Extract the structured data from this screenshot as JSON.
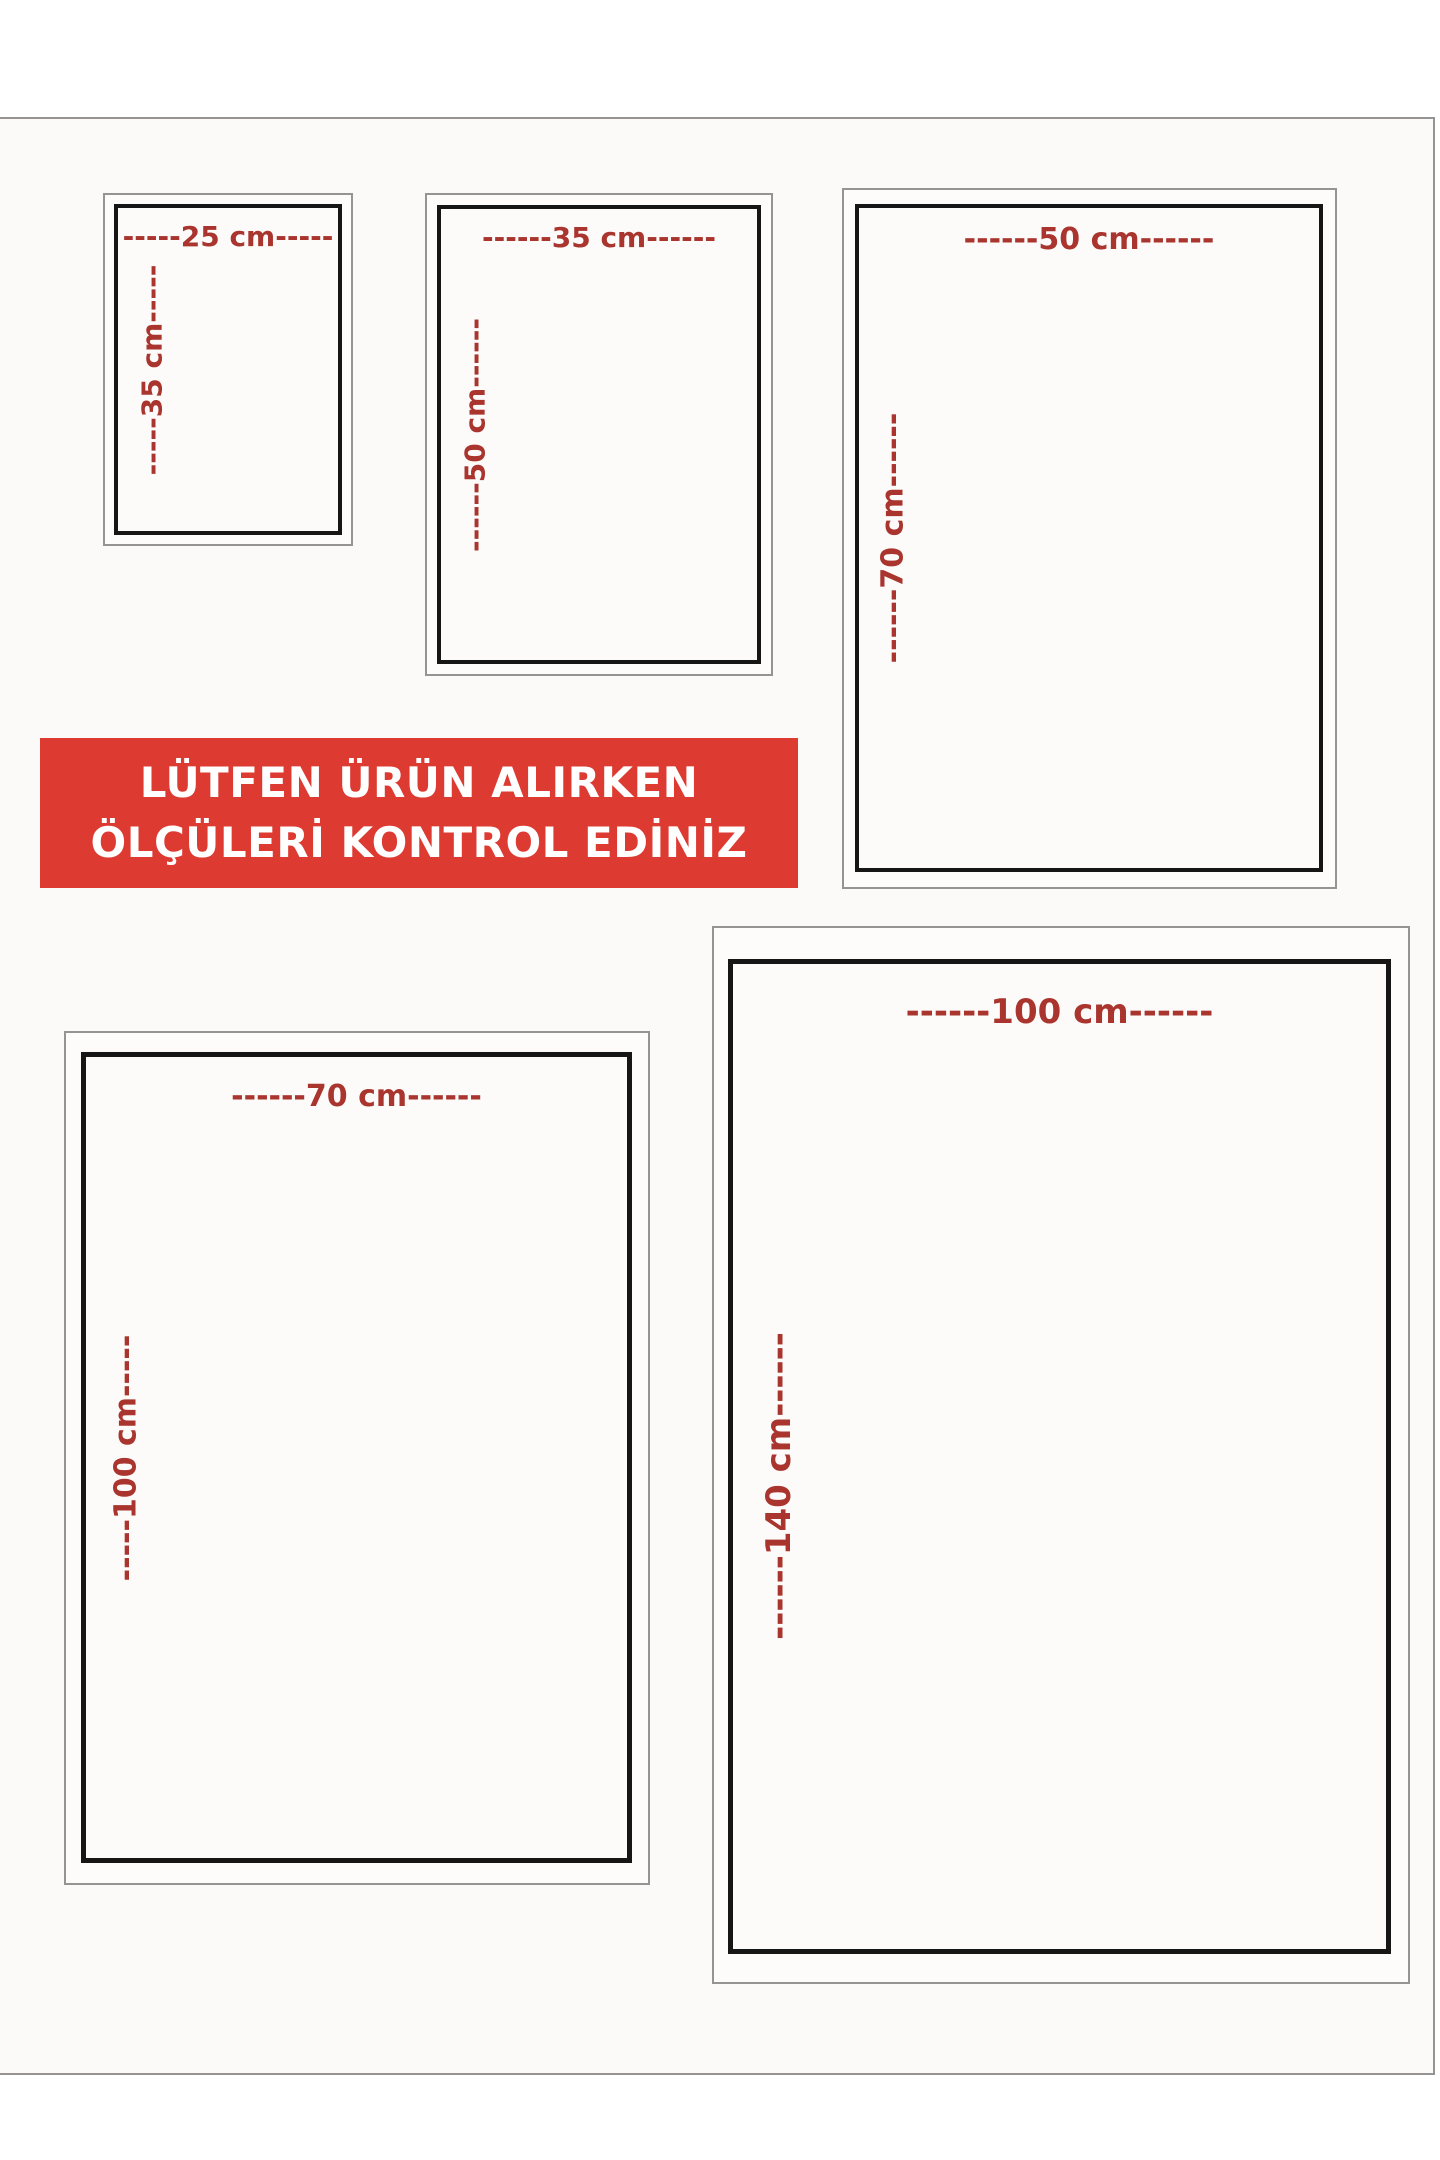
{
  "colors": {
    "page_bg": "#fbfaf9",
    "frame_gray": "#969492",
    "frame_black": "#161616",
    "label_red": "#a9352e",
    "banner_bg": "#dd3a32",
    "banner_text": "#ffffff"
  },
  "banner": {
    "line1": "LÜTFEN ÜRÜN ALIRKEN",
    "line2": "ÖLÇÜLERİ KONTROL EDİNİZ"
  },
  "sizes": [
    {
      "width_cm": 25,
      "height_cm": 35,
      "width_label": "-----25 cm-----",
      "height_label": "-----35 cm-----"
    },
    {
      "width_cm": 35,
      "height_cm": 50,
      "width_label": "------35 cm------",
      "height_label": "------50 cm------"
    },
    {
      "width_cm": 50,
      "height_cm": 70,
      "width_label": "------50 cm------",
      "height_label": "------70 cm------"
    },
    {
      "width_cm": 70,
      "height_cm": 100,
      "width_label": "------70 cm------",
      "height_label": "-----100 cm-----"
    },
    {
      "width_cm": 100,
      "height_cm": 140,
      "width_label": "------100 cm------",
      "height_label": "------140 cm------"
    }
  ]
}
